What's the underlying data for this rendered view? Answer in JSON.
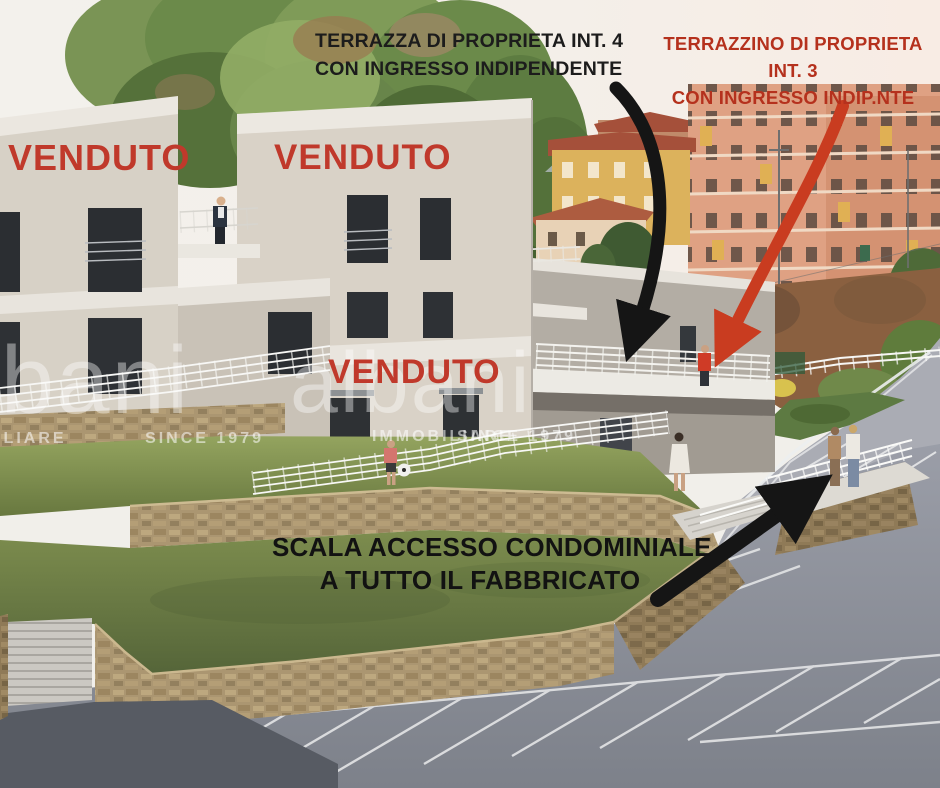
{
  "annotations": {
    "terrazza": {
      "line1": "TERRAZZA DI PROPRIETA INT. 4",
      "line2": "CON INGRESSO INDIPENDENTE"
    },
    "terrazzino": {
      "line1": "TERRAZZINO DI PROPRIETA",
      "line2": "INT. 3",
      "line3": "CON INGRESSO INDIP.NTE"
    },
    "scala": {
      "line1": "SCALA ACCESSO CONDOMINIALE",
      "line2": "A TUTTO IL FABBRICATO"
    },
    "venduto_top_left": "VENDUTO",
    "venduto_top_center": "VENDUTO",
    "venduto_lower": "VENDUTO"
  },
  "watermark": {
    "brand": "albani",
    "tagline": "IMMOBILIARE",
    "since": "SINCE 1979"
  },
  "colors": {
    "sold_red": "#c0392b",
    "annotation_black": "#1c1c1c",
    "annotation_red": "#b5311d",
    "arrow_black": "#151515",
    "arrow_red": "#c93c20"
  }
}
